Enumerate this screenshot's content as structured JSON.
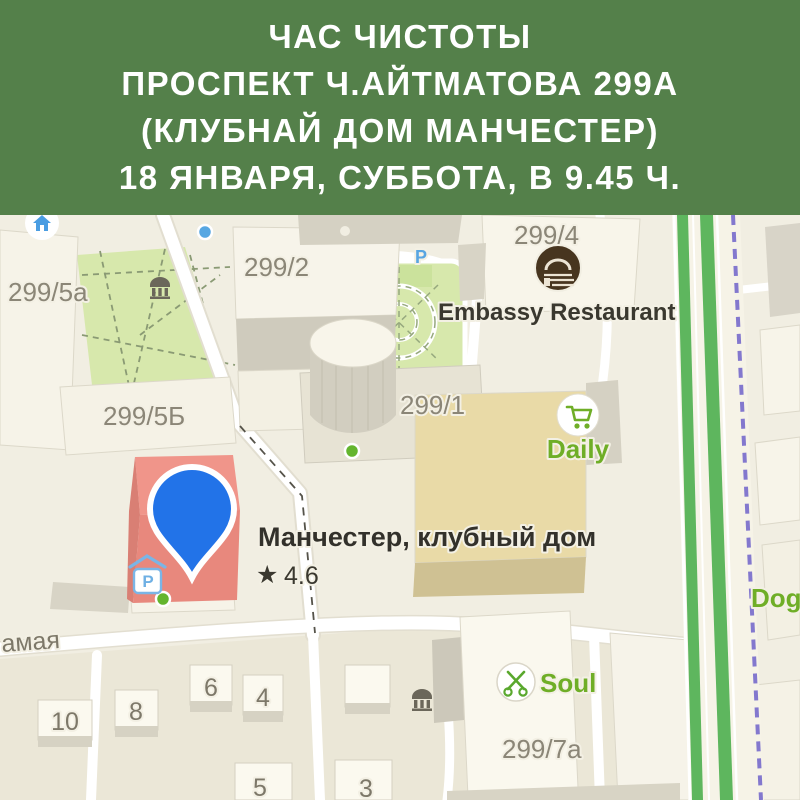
{
  "header": {
    "lines": [
      "ЧАС ЧИСТОТЫ",
      "ПРОСПЕКТ Ч.АЙТМАТОВА 299А",
      "(КЛУБНАЙ ДОМ МАНЧЕСТЕР)",
      "18 ЯНВАРЯ, СУББОТА, В 9.45 Ч."
    ],
    "bg_color": "#54804a",
    "text_color": "#ffffff"
  },
  "map": {
    "place": {
      "name": "Манчестер, клубный дом",
      "star": "★",
      "rating": "4.6"
    },
    "pois": {
      "embassy": "Embassy Restaurant",
      "daily": "Daily",
      "soul": "Soul",
      "dog": "Dog"
    },
    "building_labels": {
      "b299_5a": "299/5a",
      "b299_2": "299/2",
      "b299_4": "299/4",
      "b299_5b": "299/5Б",
      "b299_1": "299/1",
      "b299_7a": "299/7a"
    },
    "house_numbers": {
      "h10": "10",
      "h8": "8",
      "h6": "6",
      "h4": "4",
      "h5": "5",
      "h3": "3"
    },
    "street_name": "амая",
    "parking_letter": "P",
    "colors": {
      "map_background": "#f1eee2",
      "park_green": "#d7e8ac",
      "pin_blue": "#2273e8",
      "route_green": "#5eb65e",
      "boundary_purple": "#8378ce",
      "brand_green": "#6fae27",
      "highlight_building_red": "#ef9186",
      "parking_blue": "#58a5e2"
    }
  }
}
